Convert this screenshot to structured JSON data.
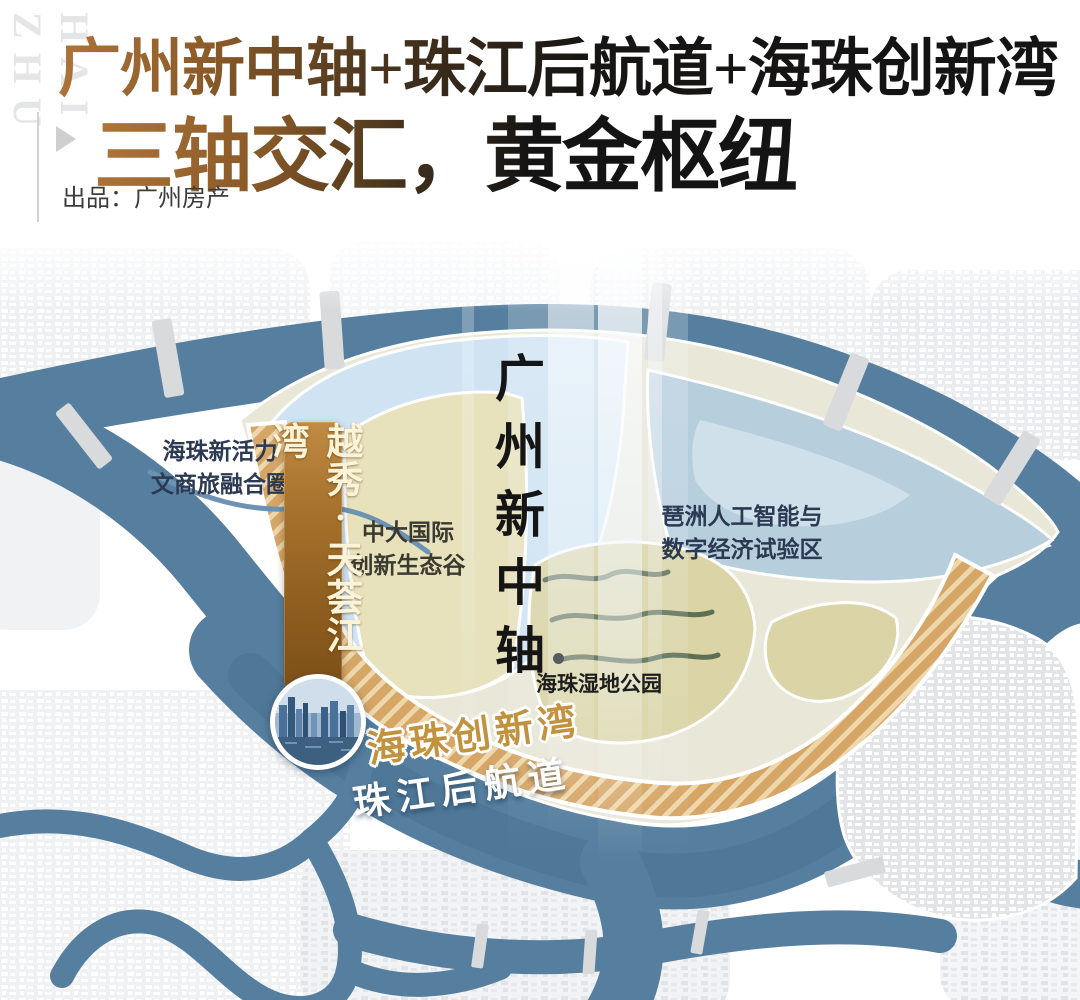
{
  "watermark": "HAI ZHU",
  "header": {
    "title_line1": "广州新中轴+珠江后航道+海珠创新湾",
    "title_line2": "三轴交汇，黄金枢纽",
    "byline": "出品：广州房产"
  },
  "map": {
    "zones": {
      "vitality": {
        "line1": "海珠新活力",
        "line2": "文商旅融合圈"
      },
      "cuhk": {
        "line1": "中大国际",
        "line2": "创新生态谷"
      },
      "axis": {
        "label": "广州新中轴"
      },
      "wetland": {
        "label": "海珠湿地公园"
      },
      "pazhou": {
        "line1": "琶洲人工智能与",
        "line2": "数字经济试验区"
      },
      "bay": {
        "label": "海珠创新湾"
      },
      "channel": {
        "label": "珠江后航道"
      }
    },
    "project_banner": {
      "label": "越秀·天荟江湾"
    }
  },
  "colors": {
    "river": "#567f9f",
    "zone_blue": "#cfe3f2",
    "zone_bluegray": "#b7cedd",
    "zone_tan": "#e7e1bc",
    "zone_wetland": "#dad4a6",
    "gold_band": "#d6a667",
    "gold_band_stripe": "#eed7ab",
    "banner_gold": "#a8742f",
    "bay_text": "#c2923f",
    "navy_label": "#2b3a52",
    "title_bronze": "#9a6531"
  }
}
